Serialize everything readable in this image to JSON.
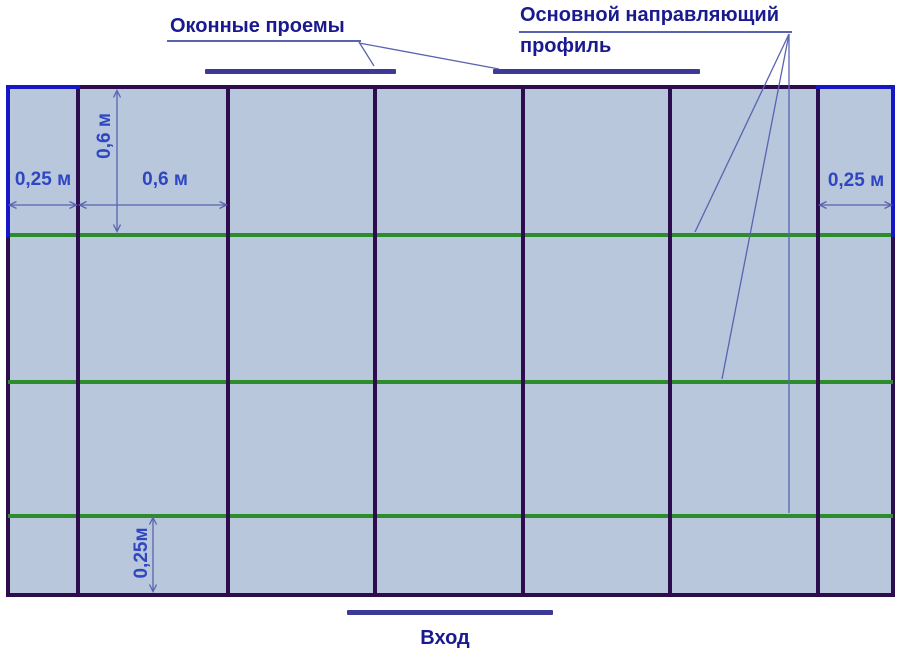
{
  "diagram": {
    "title_window_openings": "Оконные проемы",
    "title_main_profile_line1": "Основной направляющий",
    "title_main_profile_line2": "профиль",
    "entrance_label": "Вход",
    "dimensions": {
      "left_margin": "0,25 м",
      "column_width": "0,6 м",
      "row_height": "0,6 м",
      "right_margin": "0,25 м",
      "bottom_margin": "0,25м"
    },
    "grid": {
      "columns": 7,
      "rows": 4,
      "window_opening_count": 2,
      "guide_profile_count": 3
    },
    "colors": {
      "cell_fill": "#b8c7db",
      "frame": "#2e0d4e",
      "guide_profile_green": "#2d8c2d",
      "blue_edge": "#1517c4",
      "marker_bar": "#3c3a96",
      "heading_text": "#1a1a8f",
      "dimension_text": "#2e46c2",
      "thin_line": "#5a63b0"
    }
  }
}
